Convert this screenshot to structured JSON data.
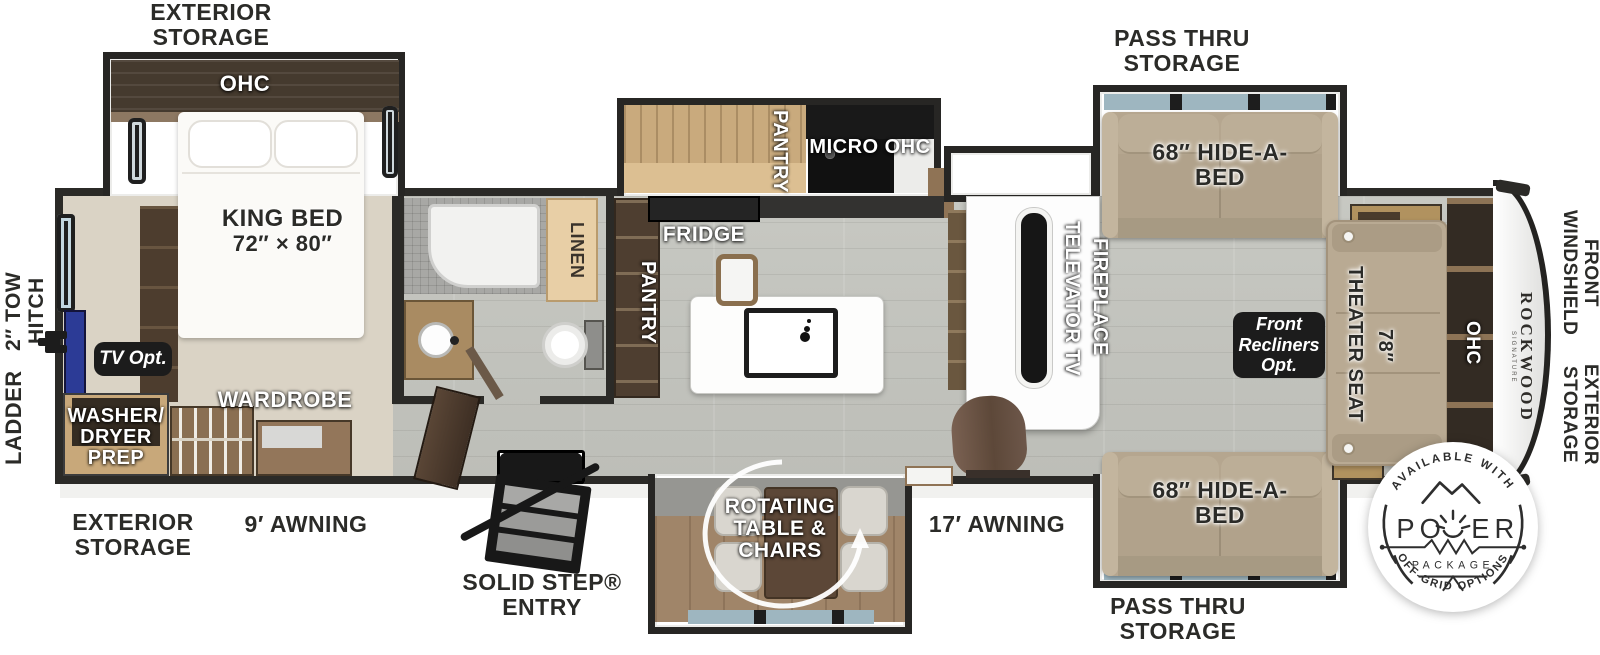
{
  "labels": {
    "storage_top": {
      "l1": "EXTERIOR",
      "l2": "STORAGE"
    },
    "ohc_bed": "OHC",
    "king_bed": {
      "l1": "KING BED",
      "l2": "72″ × 80″"
    },
    "tow_hitch": {
      "l1": "2″ TOW",
      "l2": "HITCH"
    },
    "ladder": "LADDER",
    "tv_opt": "TV Opt.",
    "washer": {
      "l1": "WASHER/",
      "l2": "DRYER",
      "l3": "PREP"
    },
    "wardrobe": "WARDROBE",
    "storage_bottom_left": {
      "l1": "EXTERIOR",
      "l2": "STORAGE"
    },
    "awning9": "9′ AWNING",
    "solid_step": {
      "l1": "SOLID STEP®",
      "l2": "ENTRY"
    },
    "linen": "LINEN",
    "pantry_bath": "PANTRY",
    "fridge": "FRIDGE",
    "pantry_kitchen": "PANTRY",
    "micro_ohc": "MICRO OHC",
    "rotating": {
      "l1": "ROTATING",
      "l2": "TABLE &",
      "l3": "CHAIRS"
    },
    "awning17": "17′ AWNING",
    "televator_tv": "TELEVATOR TV",
    "fireplace": "FIREPLACE",
    "pass_thru": {
      "l1": "PASS THRU",
      "l2": "STORAGE"
    },
    "hide_a_bed": {
      "l1": "68″ HIDE-A-",
      "l2": "BED"
    },
    "front_recliners": {
      "l1": "Front",
      "l2": "Recliners",
      "l3": "Opt."
    },
    "seat_width": "78″",
    "theater_seat": "THEATER SEAT",
    "ohc_front": "OHC",
    "front_windshield": {
      "l1": "FRONT",
      "l2": "WINDSHIELD"
    },
    "storage_right": {
      "l1": "EXTERIOR",
      "l2": "STORAGE"
    }
  },
  "brand": {
    "name": "ROCKWOOD",
    "sub": "SIGNATURE"
  },
  "badge": {
    "arc_top": "AVAILABLE WITH",
    "power_left": "PO",
    "power_right": "ER",
    "package": "PACKAGE",
    "arc_bottom": "OFF-GRID OPTIONS"
  },
  "colors": {
    "wall": "#2b2a27",
    "floor": "#c3c4be",
    "carpet": "#dad3c5",
    "wood_light": "#c9aa7d",
    "wood_dark": "#4e3e30",
    "sofa": "#b5a68f",
    "badge_bg": "#1c1c1c",
    "tv_blue": "#2c3b96"
  }
}
